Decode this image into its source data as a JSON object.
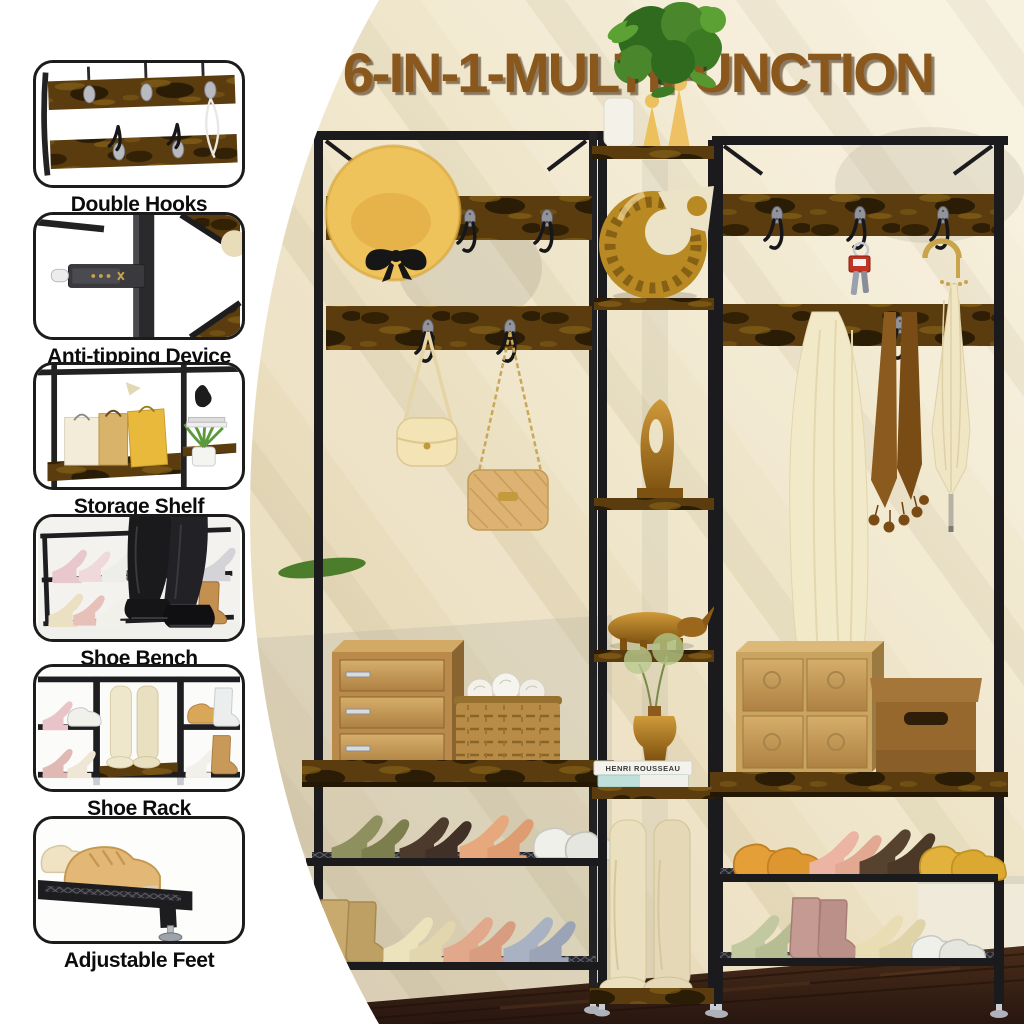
{
  "title": "6-IN-1-MULTIFUNCTION",
  "features": [
    {
      "label": "Double Hooks"
    },
    {
      "label": "Anti-tipping Device"
    },
    {
      "label": "Storage Shelf"
    },
    {
      "label": "Shoe Bench"
    },
    {
      "label": "Shoe Rack"
    },
    {
      "label": "Adjustable Feet"
    }
  ],
  "decor": {
    "book_spine": "HENRI ROUSSEAU"
  },
  "colors": {
    "title_brown": "#8a571d",
    "rustic_wood": "#5a3c0e",
    "frame_black": "#1b1b1d",
    "wall_cream": "#efe6cc",
    "floor_brown": "#3a2316",
    "gold_accent": "#c08a28",
    "hat_yellow": "#efc35c"
  }
}
